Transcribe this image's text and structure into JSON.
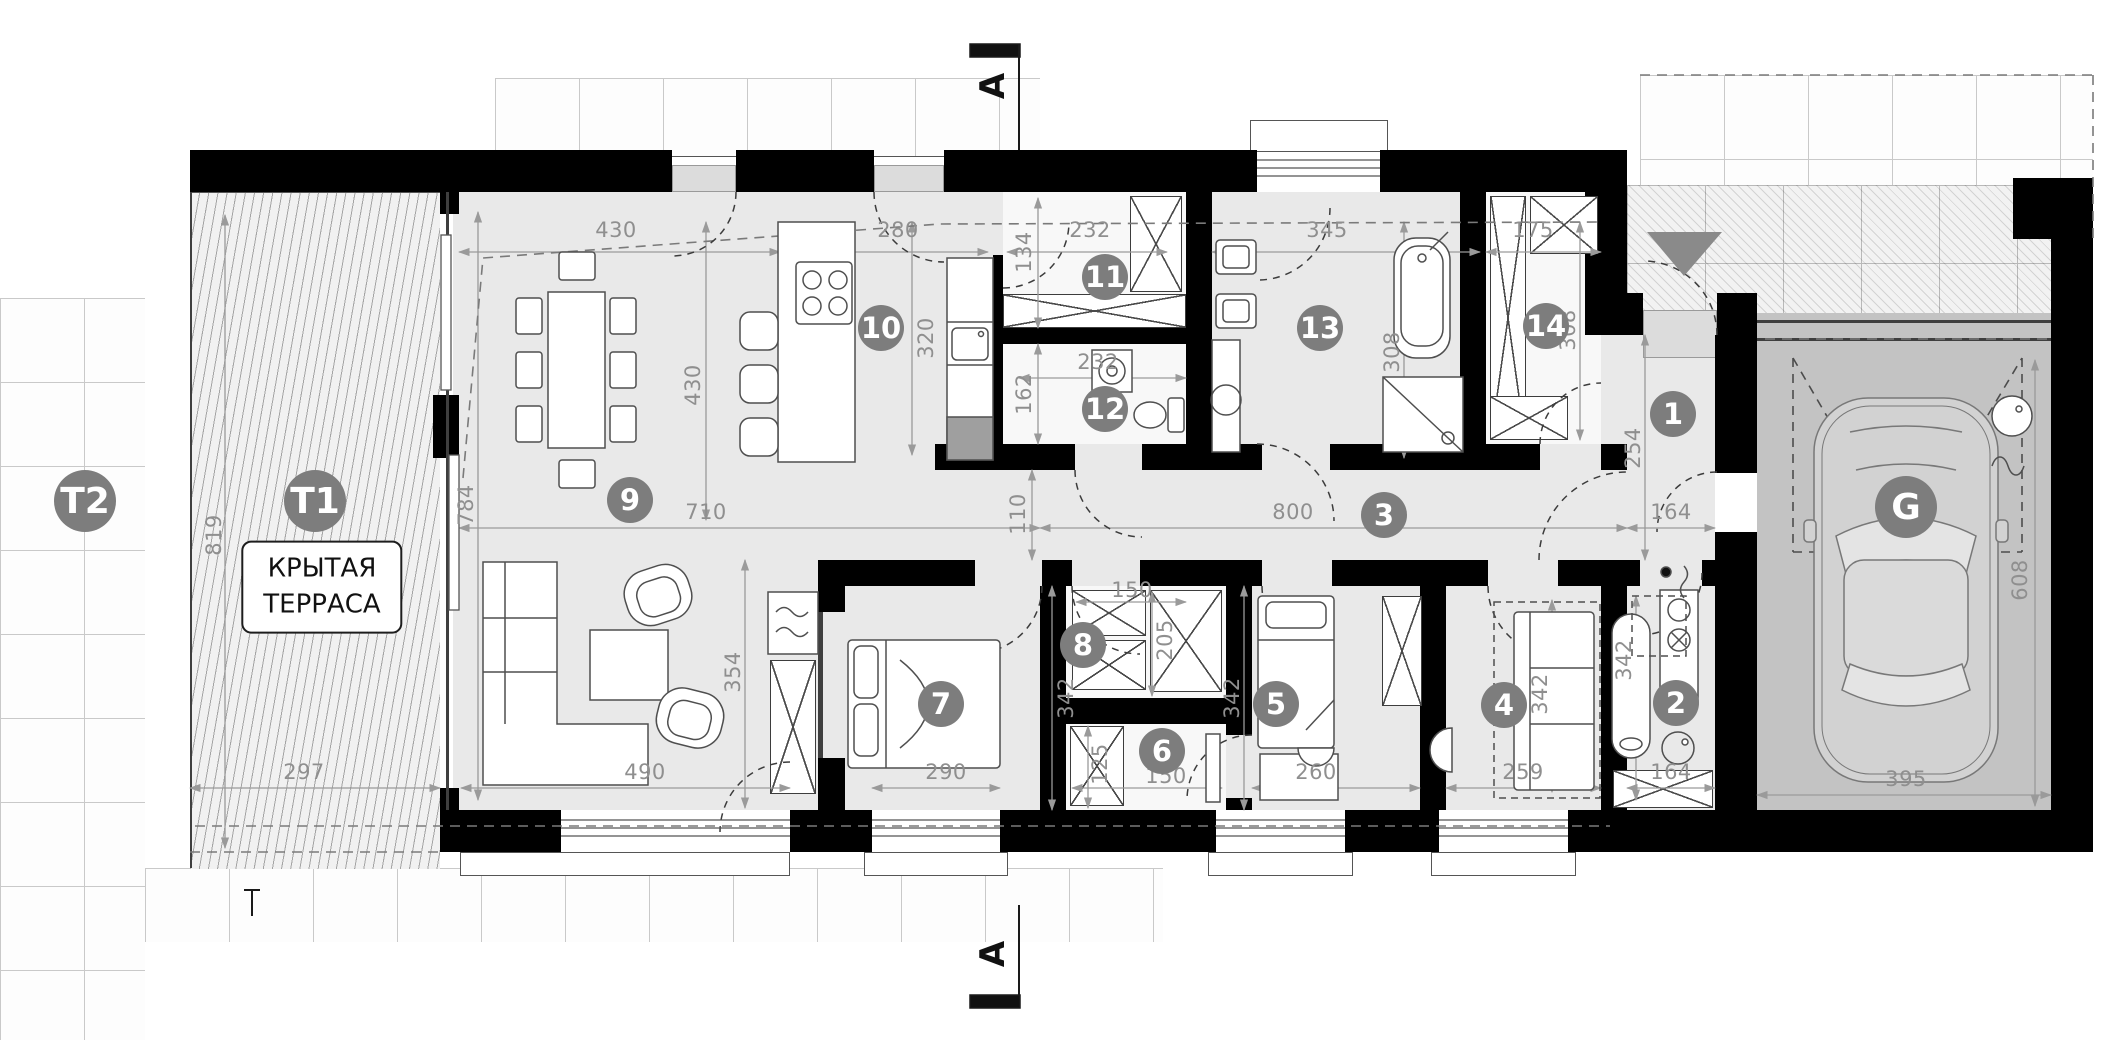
{
  "plan": {
    "type": "floor-plan",
    "language": "ru",
    "rooms": {
      "r1": "1",
      "r2": "2",
      "r3": "3",
      "r4": "4",
      "r5": "5",
      "r6": "6",
      "r7": "7",
      "r8": "8",
      "r9": "9",
      "r10": "10",
      "r11": "11",
      "r12": "12",
      "r13": "13",
      "r14": "14",
      "t1": "T1",
      "t2": "T2",
      "g": "G"
    },
    "terrace_label": {
      "line1": "КРЫТАЯ",
      "line2": "ТЕРРАСА"
    },
    "section": {
      "label": "A"
    },
    "colors": {
      "wall": "#000000",
      "floor": "#e9e9e9",
      "closet_floor": "#f8f8f8",
      "garage_floor": "#c3c3c3",
      "badge": "#7d7d7d",
      "dim_text": "#8f8f8f",
      "entrance_marker": "#8a8a8a",
      "furniture_stroke": "#4f4f4f"
    },
    "dims": {
      "top_living": "430",
      "top_kitchen": "280",
      "top_room11": "232",
      "top_room13": "345",
      "top_room14": "175",
      "v_room11": "134",
      "room12_width": "232",
      "v_room12": "162",
      "v_kitchen": "320",
      "v_living": "430",
      "v_living_left": "784",
      "v_terrace": "819",
      "v_bath": "308",
      "v_room14": "308",
      "v_corridor": "110",
      "corridor_len": "800",
      "room1_width": "164",
      "v_room1": "254",
      "terrace_width": "297",
      "living_width": "710",
      "v_living_lower": "354",
      "living_window": "490",
      "room7_width": "290",
      "v_room7": "342",
      "room8_width": "150",
      "v_room8": "205",
      "v_room6": "125",
      "room6_width": "150",
      "room5_width": "260",
      "v_room5": "342",
      "room4_width": "259",
      "v_room4": "342",
      "v_room2": "342",
      "room2_width": "164",
      "garage_width": "395",
      "v_garage": "608"
    }
  }
}
